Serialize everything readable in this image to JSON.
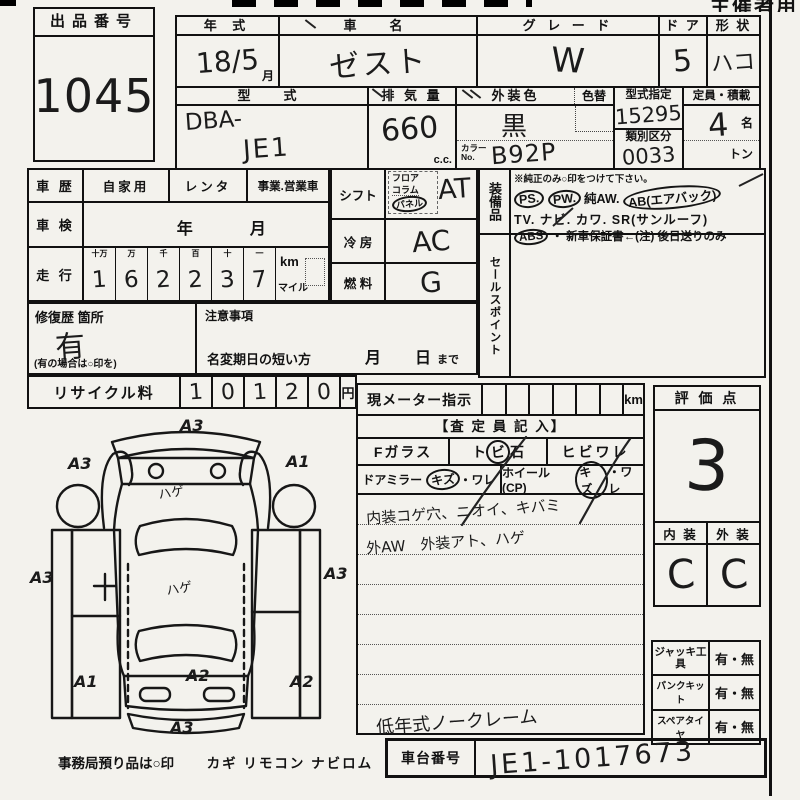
{
  "page": {
    "top_right_clip": "主催者用"
  },
  "lot": {
    "label": "出品番号",
    "number": "1045"
  },
  "spec": {
    "year": {
      "label": "年 式",
      "value": "18/5",
      "unit": "月"
    },
    "name": {
      "label": "車　名",
      "value": "ゼスト"
    },
    "grade": {
      "label": "グ レ ー ド",
      "value": "W"
    },
    "door": {
      "label": "ド ア",
      "value": "5"
    },
    "shape": {
      "label": "形 状",
      "value": "ハコ"
    },
    "model": {
      "label": "型　式",
      "prefix": "DBA-",
      "value": "JE1"
    },
    "displacement": {
      "label": "排 気 量",
      "value": "660",
      "unit": "c.c."
    },
    "color": {
      "label": "外装色",
      "change_label": "色替",
      "value": "黒",
      "no_label_1": "カラー",
      "no_label_2": "No.",
      "no_value": "B92P"
    },
    "type_designation": {
      "label": "型式指定",
      "value": "15295"
    },
    "classification": {
      "label": "類別区分",
      "value": "0033"
    },
    "capacity": {
      "label": "定員・積載",
      "value": "4",
      "unit": "名",
      "load_unit": "トン"
    }
  },
  "history": {
    "label": "車 歴",
    "opt1": "自家用",
    "opt2": "レンタ",
    "opt3": "事業.営業車"
  },
  "inspection": {
    "label": "車 検",
    "year": "年",
    "month": "月"
  },
  "mileage": {
    "label": "走 行",
    "col1": "十万",
    "col2": "万",
    "col3": "千",
    "col4": "百",
    "col5": "十",
    "col6": "一",
    "digits": [
      "1",
      "6",
      "2",
      "2",
      "3",
      "7"
    ],
    "unit_km": "km",
    "unit_mile": "マイル"
  },
  "repair": {
    "label": "修復歴 箇所",
    "value": "有",
    "note": "(有の場合は○印を)"
  },
  "caution": {
    "label": "注意事項",
    "line": "名変期日の短い方",
    "month": "月",
    "day": "日",
    "until": "まで"
  },
  "recycle": {
    "label": "リサイクル料",
    "digits": [
      "1",
      "0",
      "1",
      "2",
      "0"
    ],
    "unit": "円"
  },
  "controls": {
    "shift": {
      "label": "シフト",
      "opt1": "フロア",
      "opt2": "コラム",
      "opt3": "パネル",
      "value": "AT"
    },
    "ac": {
      "label": "冷 房",
      "value": "AC"
    },
    "fuel": {
      "label": "燃 料",
      "value": "G"
    }
  },
  "equipment": {
    "label": "装備品",
    "note": "※純正のみ○印をつけて下さい。",
    "row1": [
      "PS.",
      "PW.",
      "純AW.",
      "AB(エアバック)"
    ],
    "row2": [
      "TV.",
      "ナビ.",
      "カワ.",
      "SR(サンルーフ)"
    ],
    "row3_item": "ABS",
    "row3_rest": "・ 新車保証書←(注) 後日送りのみ"
  },
  "sales_point": {
    "label": "セールスポイント"
  },
  "assessor": {
    "meter_label": "現メーター指示",
    "meter_unit": "km",
    "title": "【査 定 員 記 入】",
    "glass_label": "Fガラス",
    "glass_opt1_pre": "ト",
    "glass_opt1_circled": "ビ",
    "glass_opt1_post": "石",
    "glass_opt2": "ヒビワレ",
    "mirror_label": "ドアミラー",
    "mirror_circled": "キズ",
    "mirror_rest": "・ワレ",
    "wheel_label": "ホイール(CP)",
    "wheel_circled": "キズ",
    "wheel_rest": "・ワレ",
    "note1": "内装コゲ穴、ニオイ、キバミ",
    "note2": "外AW　外装アト、ハゲ",
    "note_bottom": "低年式ノークレーム"
  },
  "rating": {
    "label": "評 価 点",
    "value": "3",
    "interior_label": "内 装",
    "exterior_label": "外 装",
    "interior_value": "C",
    "exterior_value": "C"
  },
  "tools": {
    "row1": {
      "label": "ジャッキ工具",
      "value": "有・無"
    },
    "row2": {
      "label": "パンクキット",
      "value": "有・無"
    },
    "row3": {
      "label": "スペアタイヤ",
      "value": "有・無"
    }
  },
  "chassis": {
    "label": "車台番号",
    "value": "JE1-1017673"
  },
  "diagram": {
    "mark_top": "A3",
    "mark_upper_left": "A3",
    "mark_upper_right": "A1",
    "mark_mid_left": "A3",
    "mark_mid_right": "A3",
    "mark_lower_left": "A1",
    "mark_trunk": "A2",
    "mark_lower_right": "A2",
    "mark_bottom": "A3",
    "hood_note": "ハゲ",
    "roof_note": "ハゲ"
  },
  "office": {
    "note": "事務局預り品は○印",
    "items": "カギ リモコン ナビロム"
  }
}
